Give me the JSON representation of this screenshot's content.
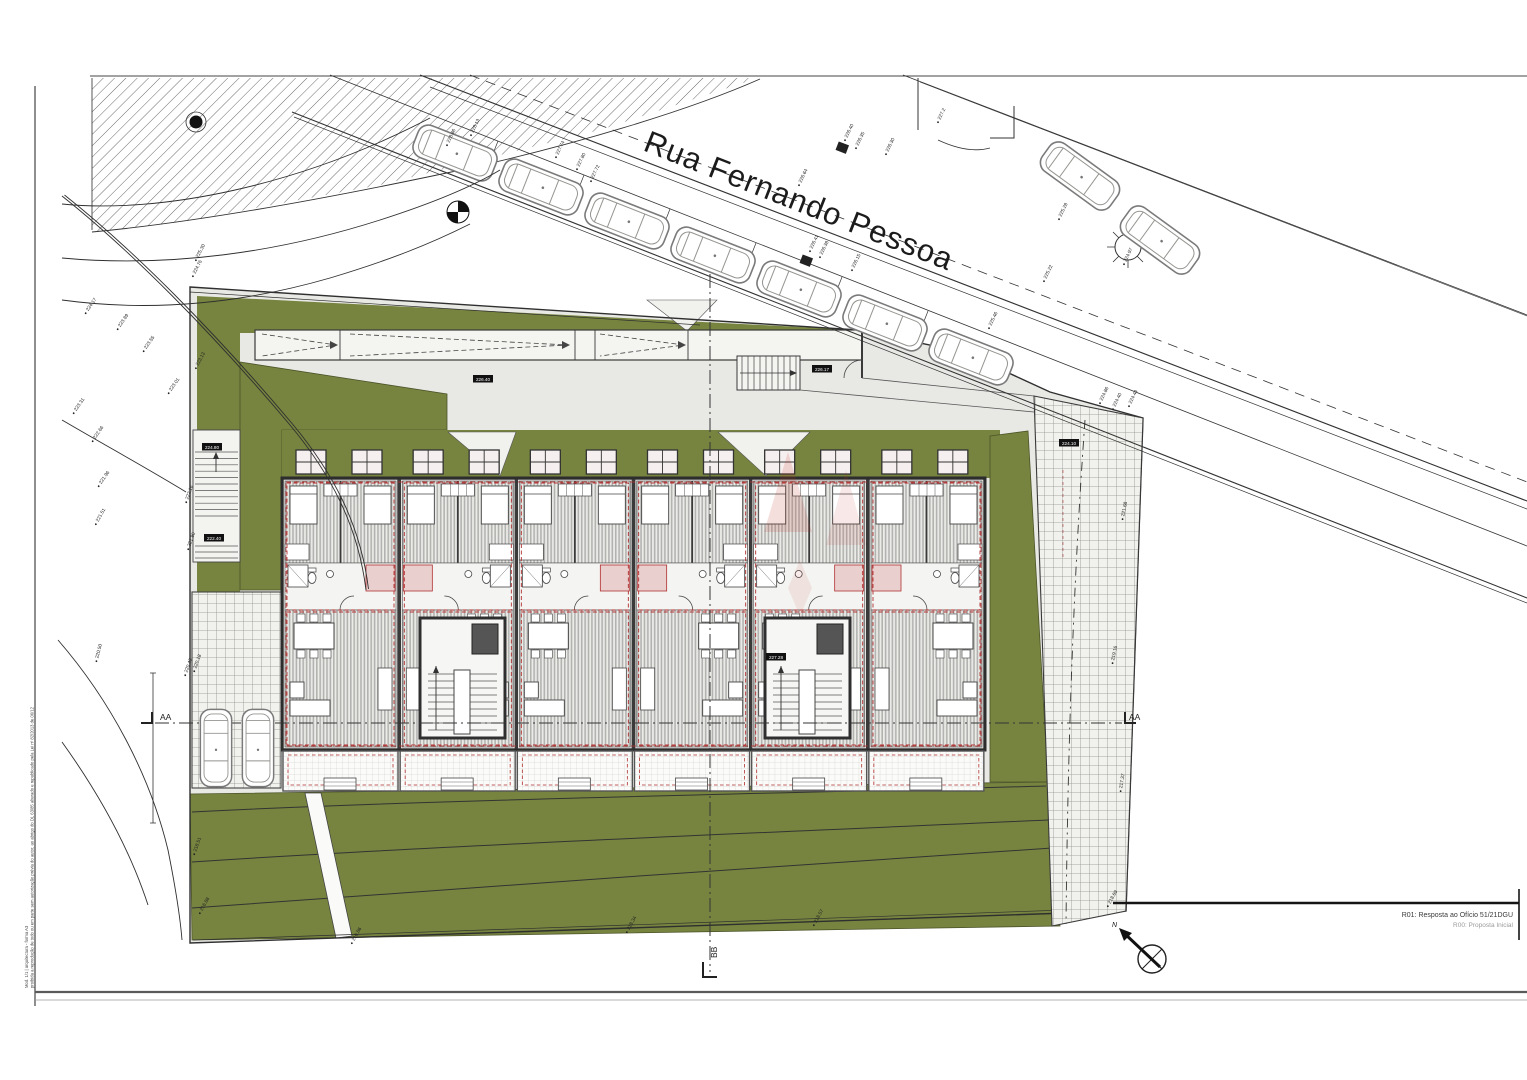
{
  "drawing": {
    "street_name": "Rua Fernando Pessoa",
    "north_label": "N",
    "section_aa": "AA",
    "section_bb": "BB",
    "revision_r01": "R01: Resposta ao Ofício 51/21DGU",
    "revision_r00": "R00: Proposta Inicial",
    "side_note_line1": "Mod. 1/1 | arquitectura - forma A3",
    "side_note_line2": "proibida a reprodução de todo ou em parte sem autorização prévia do autor, ao abrigo do DL 63/85 alterado e republicado pela Lei nº 82/2013 de 06/12"
  },
  "palette": {
    "lawn_green": "#76843f",
    "paving_gray": "#e8e8e5",
    "overlay_red": "#b03030",
    "line_dark": "#2f2f2f"
  },
  "site": {
    "units": 6,
    "skylights_per_unit": 2,
    "road_cars": 7,
    "upper_road_cars": 2,
    "parking_cars": 2
  },
  "level_boxes": [
    {
      "t": "226.40",
      "x": 483,
      "y": 379
    },
    {
      "t": "226.17",
      "x": 822,
      "y": 369
    },
    {
      "t": "224.10",
      "x": 1069,
      "y": 443
    },
    {
      "t": "224.80",
      "x": 212,
      "y": 447
    },
    {
      "t": "222.40",
      "x": 214,
      "y": 538
    },
    {
      "t": "227.28",
      "x": 776,
      "y": 657
    }
  ],
  "elevation_labels": [
    {
      "t": "228.86",
      "x": 447,
      "y": 143,
      "r": -64
    },
    {
      "t": "228.13",
      "x": 471,
      "y": 133,
      "r": -64
    },
    {
      "t": "227.74",
      "x": 556,
      "y": 155,
      "r": -64
    },
    {
      "t": "227.80",
      "x": 577,
      "y": 167,
      "r": -64
    },
    {
      "t": "227.72",
      "x": 591,
      "y": 179,
      "r": -64
    },
    {
      "t": "226.64",
      "x": 799,
      "y": 183,
      "r": -64
    },
    {
      "t": "226.40",
      "x": 845,
      "y": 138,
      "r": -64
    },
    {
      "t": "226.35",
      "x": 856,
      "y": 146,
      "r": -64
    },
    {
      "t": "226.30",
      "x": 886,
      "y": 152,
      "r": -64
    },
    {
      "t": "227.2",
      "x": 938,
      "y": 120,
      "r": -64
    },
    {
      "t": "226.41",
      "x": 810,
      "y": 249,
      "r": -64
    },
    {
      "t": "226.38",
      "x": 820,
      "y": 255,
      "r": -64
    },
    {
      "t": "226.15",
      "x": 852,
      "y": 268,
      "r": -64
    },
    {
      "t": "225.28",
      "x": 1059,
      "y": 217,
      "r": -64
    },
    {
      "t": "225.22",
      "x": 1044,
      "y": 279,
      "r": -64
    },
    {
      "t": "225.46",
      "x": 989,
      "y": 326,
      "r": -64
    },
    {
      "t": "224.97",
      "x": 1124,
      "y": 262,
      "r": -64
    },
    {
      "t": "225.30",
      "x": 196,
      "y": 258,
      "r": -62
    },
    {
      "t": "224.76",
      "x": 193,
      "y": 274,
      "r": -62
    },
    {
      "t": "224.17",
      "x": 86,
      "y": 311,
      "r": -55
    },
    {
      "t": "223.89",
      "x": 118,
      "y": 327,
      "r": -55
    },
    {
      "t": "223.55",
      "x": 144,
      "y": 349,
      "r": -55
    },
    {
      "t": "223.13",
      "x": 196,
      "y": 366,
      "r": -62
    },
    {
      "t": "223.01",
      "x": 169,
      "y": 391,
      "r": -55
    },
    {
      "t": "223.31",
      "x": 74,
      "y": 411,
      "r": -55
    },
    {
      "t": "222.66",
      "x": 93,
      "y": 439,
      "r": -55
    },
    {
      "t": "221.96",
      "x": 99,
      "y": 484,
      "r": -55
    },
    {
      "t": "221.51",
      "x": 96,
      "y": 522,
      "r": -60
    },
    {
      "t": "222.16",
      "x": 186,
      "y": 500,
      "r": -70
    },
    {
      "t": "221.80",
      "x": 188,
      "y": 547,
      "r": -70
    },
    {
      "t": "220.50",
      "x": 96,
      "y": 659,
      "r": -75
    },
    {
      "t": "220.43",
      "x": 185,
      "y": 673,
      "r": -70
    },
    {
      "t": "220.18",
      "x": 194,
      "y": 669,
      "r": -70
    },
    {
      "t": "224.86",
      "x": 1100,
      "y": 401,
      "r": -64
    },
    {
      "t": "224.40",
      "x": 1113,
      "y": 407,
      "r": -64
    },
    {
      "t": "224.44",
      "x": 1129,
      "y": 404,
      "r": -64
    },
    {
      "t": "221.68",
      "x": 1122,
      "y": 517,
      "r": -78
    },
    {
      "t": "219.16",
      "x": 1112,
      "y": 661,
      "r": -78
    },
    {
      "t": "217.37",
      "x": 1120,
      "y": 789,
      "r": -80
    },
    {
      "t": "218.69",
      "x": 1108,
      "y": 904,
      "r": -60
    },
    {
      "t": "218.34",
      "x": 627,
      "y": 930,
      "r": -60
    },
    {
      "t": "218.57",
      "x": 814,
      "y": 923,
      "r": -60
    },
    {
      "t": "216.86",
      "x": 352,
      "y": 941,
      "r": -60
    },
    {
      "t": "218.51",
      "x": 194,
      "y": 852,
      "r": -70
    },
    {
      "t": "216.88",
      "x": 200,
      "y": 911,
      "r": -60
    }
  ]
}
